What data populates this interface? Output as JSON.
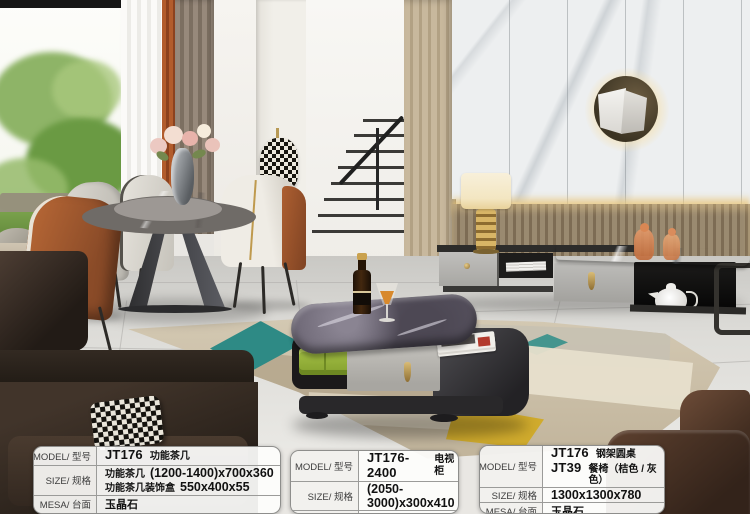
{
  "tables": {
    "t1": {
      "model_label": "MODEL/ 型号",
      "model_code": "JT176",
      "model_name": "功能茶几",
      "size_label": "SIZE/ 规格",
      "size1_name": "功能茶几",
      "size1_value": "(1200-1400)x700x360",
      "size2_name": "功能茶几装饰盒",
      "size2_value": "550x400x55",
      "mesa_label": "MESA/ 台面",
      "mesa_value": "玉晶石"
    },
    "t2": {
      "model_label": "MODEL/ 型号",
      "model_code": "JT176- 2400",
      "model_name": "电视柜",
      "size_label": "SIZE/ 规格",
      "size_value": "(2050-3000)x300x410",
      "mesa_label": "MESA/ 台面",
      "mesa_value": "玉晶石"
    },
    "t3": {
      "model_label": "MODEL/ 型号",
      "model1_code": "JT176",
      "model1_name": "钢架圆桌",
      "model2_code": "JT39",
      "model2_name": "餐椅（桔色 / 灰色）",
      "size_label": "SIZE/ 规格",
      "size_value": "1300x1300x780",
      "mesa_label": "MESA/ 台面",
      "mesa_value": "玉晶石"
    }
  },
  "scene_colors": {
    "curtain_rust": "#a85427",
    "curtain_taupe": "#8b7d6f",
    "carpet_teal": "#2e8a85",
    "carpet_yellow": "#d0ab2d",
    "tray_green": "#94b03a",
    "gold_hardware": "#c9a254",
    "leather_brown": "#5e412f",
    "coffee_table_marble": "#645f6d",
    "wall_lamp_glow": "#f4e0b0",
    "wood_panel": "#b2a184"
  }
}
